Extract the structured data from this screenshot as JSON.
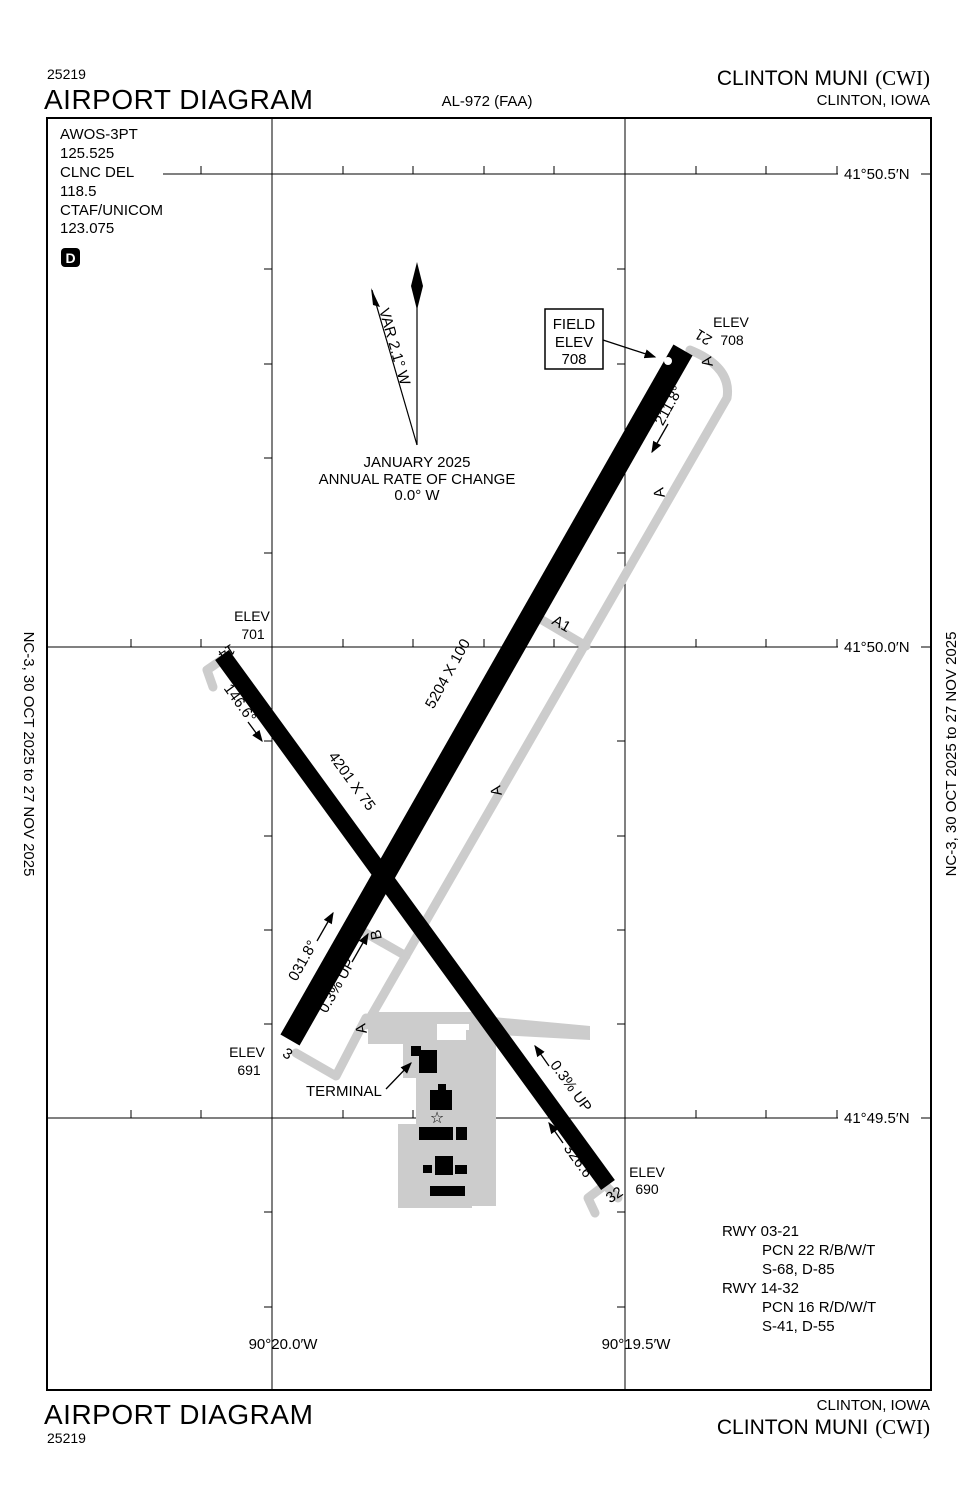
{
  "header": {
    "chart_code": "25219",
    "title": "AIRPORT DIAGRAM",
    "procedure_id": "AL-972 (FAA)",
    "airport_name": "CLINTON MUNI",
    "airport_icao": "(CWI)",
    "city": "CLINTON, IOWA"
  },
  "footer": {
    "title": "AIRPORT DIAGRAM",
    "chart_code": "25219",
    "city": "CLINTON, IOWA",
    "airport_name": "CLINTON MUNI",
    "airport_icao": "(CWI)"
  },
  "side_notes": {
    "left": "NC-3,  30 OCT 2025  to  27 NOV 2025",
    "right": "NC-3,  30 OCT 2025  to  27 NOV 2025"
  },
  "comm": {
    "awos_label": "AWOS-3PT",
    "awos_freq": "125.525",
    "clnc_label": "CLNC DEL",
    "clnc_freq": "118.5",
    "ctaf_label": "CTAF/UNICOM",
    "ctaf_freq": "123.075",
    "d_symbol": "D"
  },
  "north": {
    "var_label": "VAR 2.1° W",
    "line1": "JANUARY 2025",
    "line2": "ANNUAL RATE OF CHANGE",
    "line3": "0.0° W"
  },
  "field_elev": {
    "line1": "FIELD",
    "line2": "ELEV",
    "value": "708"
  },
  "labels": {
    "elev": "ELEV",
    "terminal": "TERMINAL",
    "beacon": "☆"
  },
  "grid": {
    "lat1": "41°50.5′N",
    "lat2": "41°50.0′N",
    "lat3": "41°49.5′N",
    "lon1": "90°20.0′W",
    "lon2": "90°19.5′W"
  },
  "runway_03_21": {
    "num_3": "3",
    "num_21": "21",
    "dimensions": "5204 X 100",
    "heading_03": "031.8°",
    "heading_21": "211.8°",
    "gradient": "0.3% UP",
    "elev_3": "691",
    "elev_21": "708"
  },
  "runway_14_32": {
    "num_14": "14",
    "num_32": "32",
    "dimensions": "4201 X 75",
    "heading_14": "146.6°",
    "heading_32": "326.6°",
    "gradient": "0.3% UP",
    "elev_14": "701",
    "elev_32": "690"
  },
  "taxiways": {
    "a": "A",
    "a1": "A1",
    "b": "B"
  },
  "rwy_info": {
    "l1": "RWY 03-21",
    "l2": "PCN 22 R/B/W/T",
    "l3": "S-68, D-85",
    "l4": "RWY 14-32",
    "l5": "PCN 16 R/D/W/T",
    "l6": "S-41, D-55"
  },
  "colors": {
    "taxiway_gray": "#cccccc",
    "ink": "#000000"
  }
}
